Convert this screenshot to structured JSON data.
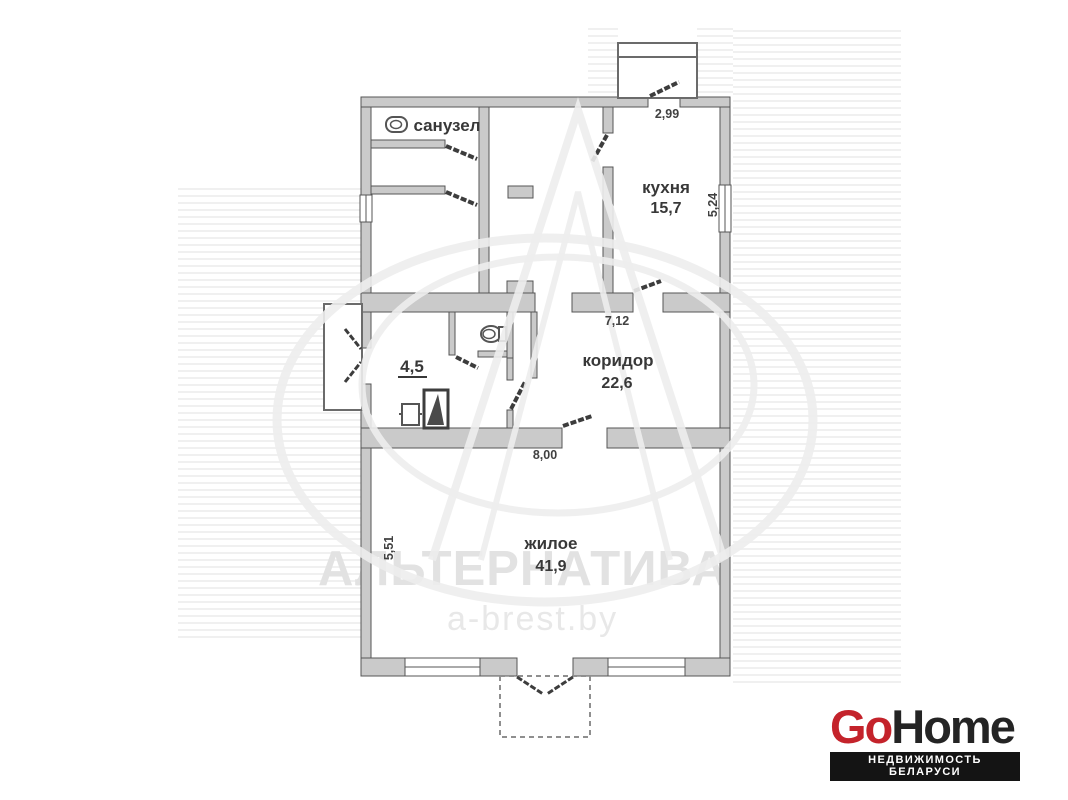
{
  "plan": {
    "rooms": [
      {
        "name": "санузел",
        "area": ""
      },
      {
        "name": "кухня",
        "area": "15,7"
      },
      {
        "name": "коридор",
        "area": "22,6"
      },
      {
        "name": "",
        "area": "4,5"
      },
      {
        "name": "жилое",
        "area": "41,9"
      }
    ],
    "dims": {
      "entry_top": "2,99",
      "kitchen_side": "5,24",
      "corridor_top": "7,12",
      "living_top": "8,00",
      "living_side": "5,51"
    },
    "icons": [
      "toilet-icon",
      "toilet-icon",
      "basin-icon",
      "stove-icon"
    ],
    "wall_color": "#cacaca"
  },
  "watermark": {
    "title": "АЛЬТЕРНАТИВА",
    "site": "a-brest.by"
  },
  "logo": {
    "go": "Go",
    "home": "Home",
    "tagline": "НЕДВИЖИМОСТЬ БЕЛАРУСИ",
    "accent_color": "#c4232b",
    "dark_color": "#242424",
    "bar_bg": "#141414"
  }
}
